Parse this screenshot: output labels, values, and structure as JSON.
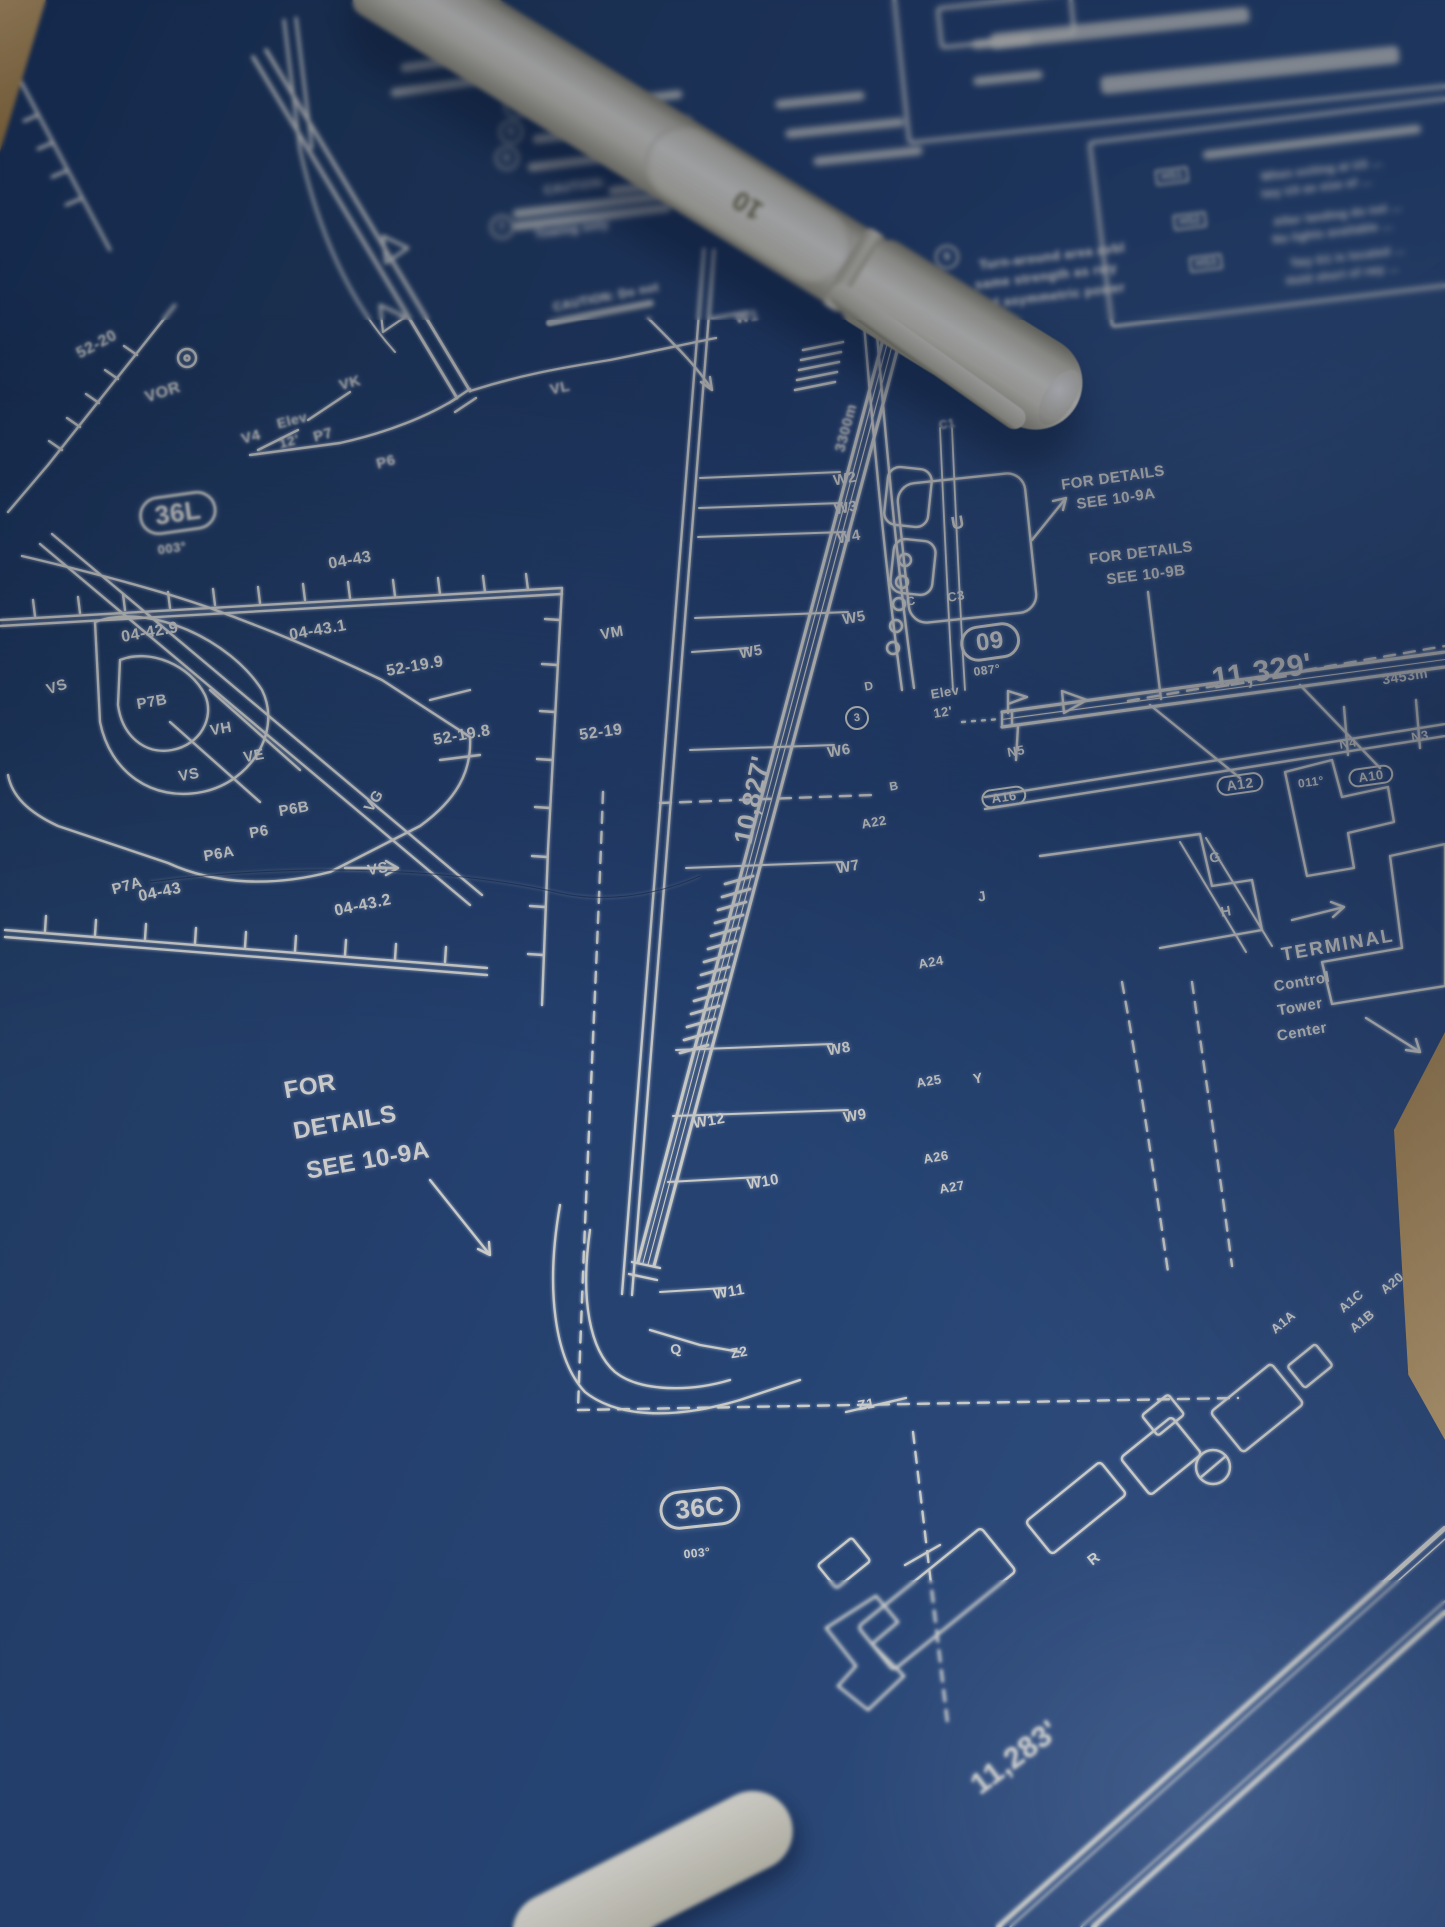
{
  "colors": {
    "paper_blue": "#2b4a7d",
    "ink_white": "#f3f3ea",
    "table_tan": "#c9a266",
    "pen_body": "#efecdf"
  },
  "pen": {
    "marking": "10"
  },
  "top_notes": {
    "item4_num": "4",
    "item5_num": "5",
    "item6_num": "6",
    "item7_num": "7",
    "caution": "CAUTION:",
    "item7_text": "Towing only"
  },
  "mid_caution": {
    "line1": "CAUTION: Do not"
  },
  "note9": {
    "num": "9",
    "line1": "Turn-around area avbl",
    "line2": "same strength as rwy",
    "line3": "and asymmetric power"
  },
  "hotspots": {
    "hs1": {
      "tag": "HS1",
      "line1": "When exiting at U3 …",
      "line2": "twy U3 as size of …"
    },
    "hs2": {
      "tag": "HS2",
      "line1": "After landing do not …",
      "line2": "No lights available …"
    },
    "hs3": {
      "tag": "HS3",
      "line1": "Twy G1 is located …",
      "line2": "Hold short of rwy …"
    }
  },
  "details": {
    "left": {
      "l1": "FOR",
      "l2": "DETAILS",
      "l3": "SEE 10-9A"
    },
    "refA": {
      "l1": "FOR DETAILS",
      "l2": "SEE 10-9A"
    },
    "refB": {
      "l1": "FOR DETAILS",
      "l2": "SEE 10-9B"
    }
  },
  "runways": {
    "r36l": {
      "ident": "36L",
      "heading": "003°"
    },
    "r36c": {
      "ident": "36C",
      "heading": "003°"
    },
    "r09": {
      "ident": "09",
      "heading": "087°"
    },
    "r36c_len_ft": "10,827'",
    "r36c_len_m": "3300m",
    "r09_len_ft": "11,329'",
    "r09_len_m": "3453m",
    "r36r_len_ft": "11,283'"
  },
  "elevation": {
    "label": "Elev",
    "value": "12'"
  },
  "grid_labels": {
    "a": "52-20",
    "b": "04-43",
    "c": "04-42.9",
    "d": "04-43.1",
    "e": "52-19.9",
    "f": "52-19.8",
    "g": "52-19",
    "h": "04-43",
    "i": "04-43.2"
  },
  "nav": {
    "vor1": "VOR",
    "vor2": "VOR"
  },
  "taxiways": {
    "vk": "VK",
    "v4": "V4",
    "p7_top": "P7",
    "p6_top": "P6",
    "vl": "VL",
    "vm": "VM",
    "vs1": "VS",
    "p7b": "P7B",
    "p7a": "P7A",
    "vh": "VH",
    "ve": "VE",
    "vs2": "VS",
    "p6b": "P6B",
    "p6": "P6",
    "p6a": "P6A",
    "vg": "VG",
    "vs3": "VS",
    "w1": "W1",
    "w2": "W2",
    "w3": "W3",
    "w4": "W4",
    "w5a": "W5",
    "w5b": "W5",
    "w6": "W6",
    "w7": "W7",
    "w8": "W8",
    "w9": "W9",
    "w10": "W10",
    "w11": "W11",
    "w12": "W12",
    "a22": "A22",
    "a24": "A24",
    "a25": "A25",
    "y": "Y",
    "a26": "A26",
    "a27": "A27",
    "a12": "A12",
    "a10": "A10",
    "a16": "A16",
    "hdg011": "011°",
    "n3": "N3",
    "n4": "N4",
    "n5": "N5",
    "c1": "C1",
    "c": "C",
    "c3": "C3",
    "u": "U",
    "d": "D",
    "b": "B",
    "g": "G",
    "h": "H",
    "j": "J",
    "q": "Q",
    "z1": "Z1",
    "z2": "Z2",
    "r": "R",
    "note3": "3",
    "a20": "A20",
    "a1c": "A1C",
    "a1b": "A1B",
    "a1a": "A1A"
  },
  "terminal": {
    "title": "TERMINAL",
    "line1": "Control",
    "line2": "Tower",
    "line3": "Center"
  }
}
